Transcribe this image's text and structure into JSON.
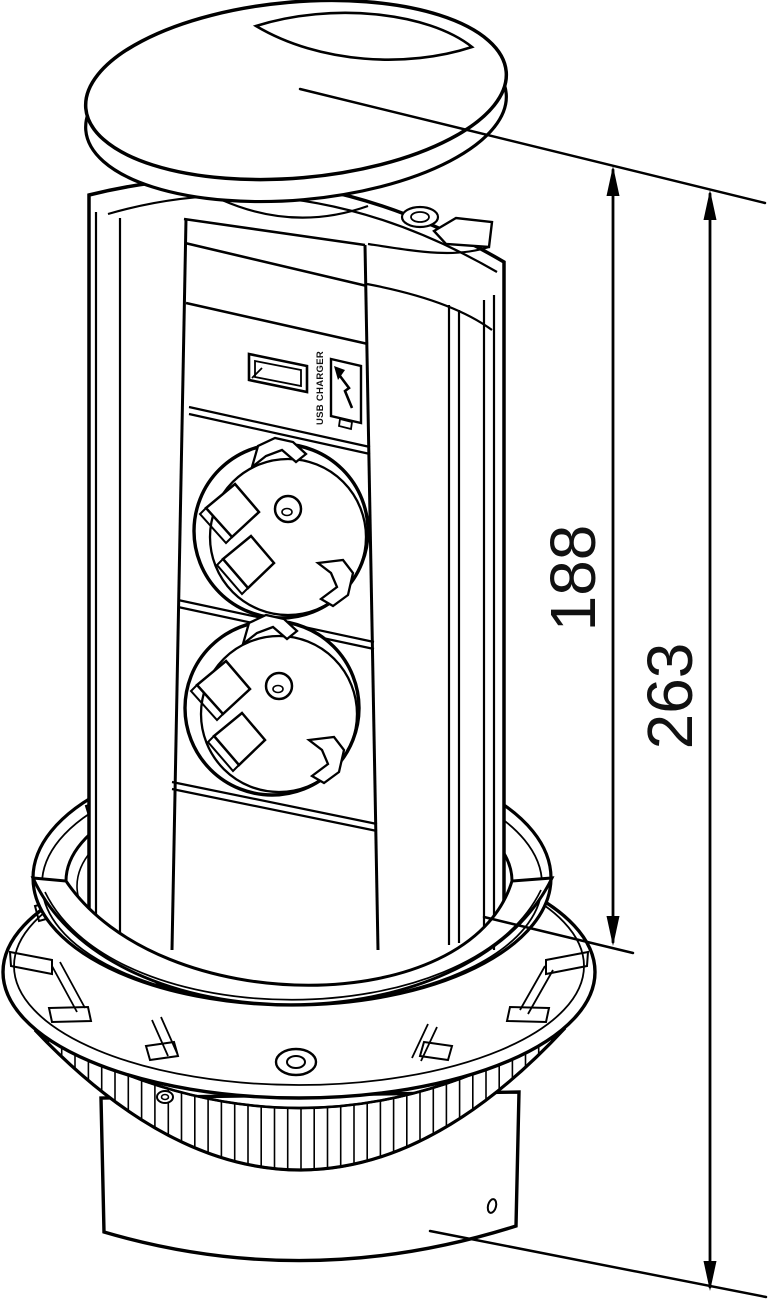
{
  "diagram": {
    "type": "technical-line-drawing",
    "background": "#ffffff",
    "line_color": "#000000",
    "subject": "pop-up power socket tower, isometric view",
    "dimensions": [
      {
        "label": "188"
      },
      {
        "label": "263"
      }
    ],
    "labels": {
      "usb_charger": "USB CHARGER"
    },
    "icons": [
      "usb-port-icon",
      "lightning-arrow-icon",
      "schuko-socket-icon",
      "screw-icon"
    ]
  }
}
